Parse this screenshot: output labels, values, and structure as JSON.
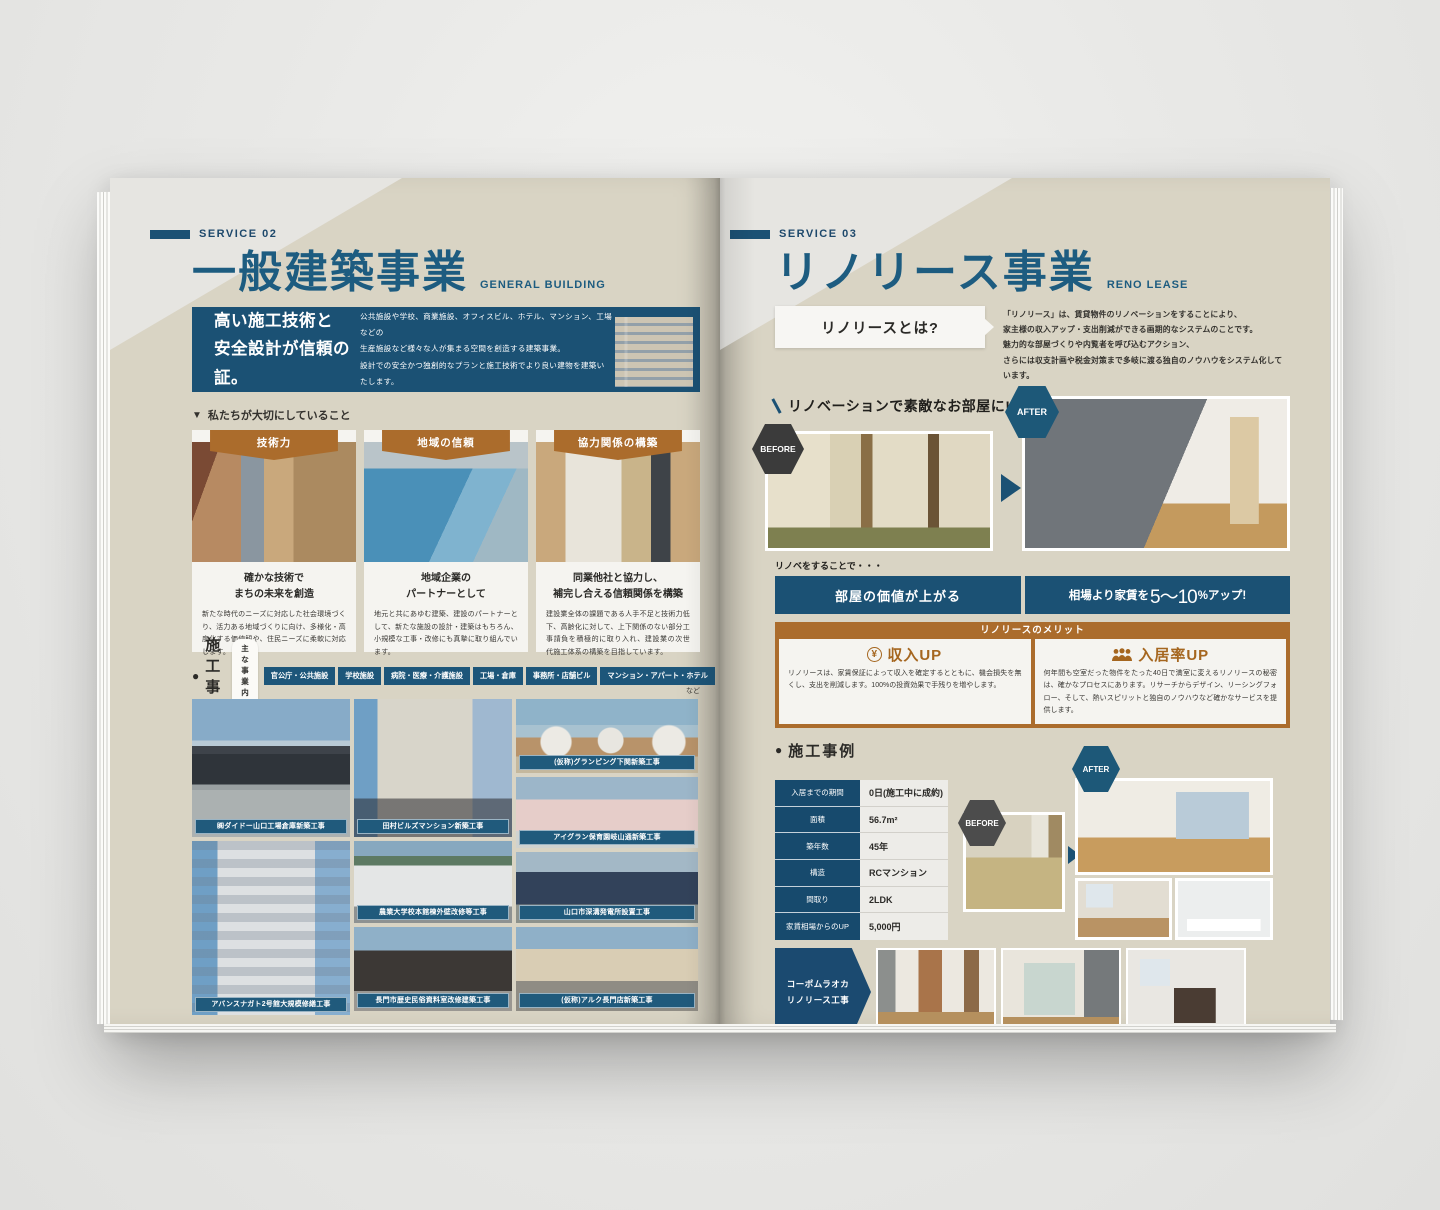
{
  "theme": {
    "primary_blue": "#1b5174",
    "accent_orange": "#ab6c2c",
    "page_beige": "#d9d4c4"
  },
  "icons": {
    "values_marker": "▼",
    "works_marker": "●",
    "yen": "¥"
  },
  "page_left": {
    "service_tag": "SERVICE 02",
    "title": "一般建築事業",
    "title_en": "GENERAL BUILDING",
    "page_number": "03",
    "hero": {
      "headline1": "高い施工技術と",
      "headline2": "安全設計が信頼の証。",
      "desc1": "公共施設や学校、商業施設、オフィスビル、ホテル、マンション、工場などの",
      "desc2": "生産施設など様々な人が集まる空間を創造する建築事業。",
      "desc3": "設計での安全かつ独創的なプランと施工技術でより良い建物を建築いたします。"
    },
    "values_heading": "私たちが大切にしていること",
    "cards": [
      {
        "badge": "技術力",
        "title1": "確かな技術で",
        "title2": "まちの未来を創造",
        "body": "新たな時代のニーズに対応した社会環境づくり、活力ある地域づくりに向け、多様化・高度化する価値観や、住民ニーズに柔軟に対応します。"
      },
      {
        "badge": "地域の信頼",
        "title1": "地域企業の",
        "title2": "パートナーとして",
        "body": "地元と共にあゆむ建築、建設のパートナーとして、新たな施設の設計・建築はもちろん、小規模な工事・改修にも真摯に取り組んでいます。"
      },
      {
        "badge": "協力関係の構築",
        "title1": "同業他社と協力し、",
        "title2": "補完し合える信頼関係を構築",
        "body": "建設業全体の課題である人手不足と技術力低下、高齢化に対して、上下関係のない部分工事請負を積極的に取り入れ、建設業の次世代施工体系の構築を目指しています。"
      }
    ],
    "works": {
      "heading": "施工事例",
      "pill": "主な事業内容",
      "tags": [
        "官公庁・公共施設",
        "学校施設",
        "病院・医療・介護施設",
        "工場・倉庫",
        "事務所・店舗ビル",
        "マンション・アパート・ホテル"
      ],
      "tags_note": "など",
      "col1": [
        "㈱ダイドー山口工場倉庫新築工事",
        "アバンスナガト2号館大規模修繕工事"
      ],
      "col2": [
        "田村ビルズマンション新築工事",
        "農業大学校本館棟外壁改修等工事",
        "長門市歴史民俗資料室改修建築工事"
      ],
      "col3": [
        "(仮称)グランピング下関新築工事",
        "アイグラン保育園岐山通新築工事",
        "山口市深溝発電所設置工事",
        "(仮称)アルク長門店新築工事"
      ]
    }
  },
  "page_right": {
    "service_tag": "SERVICE 03",
    "title": "リノリース事業",
    "title_en": "RENO LEASE",
    "page_number": "04",
    "intro": {
      "label": "リノリースとは?",
      "desc1": "「リノリース」は、賃貸物件のリノベーションをすることにより、",
      "desc2": "家主様の収入アップ・支出削減ができる画期的なシステムのことです。",
      "desc3": "魅力的な部屋づくりや内覧者を呼び込むアクション、",
      "desc4": "さらには収支計画や税金対策まで多岐に渡る独自のノウハウをシステム化しています。"
    },
    "renov_label": "リノベーションで素敵なお部屋に!",
    "before_label": "BEFORE",
    "after_label": "AFTER",
    "renobe_note": "リノベをすることで・・・",
    "bar1": "部屋の価値が上がる",
    "bar2_prefix": "相場より家賃を",
    "bar2_value": "5〜10",
    "bar2_suffix": "%アップ!",
    "merit": {
      "heading": "リノリースのメリット",
      "m1_title": "収入UP",
      "m1_body": "リノリースは、家賃保証によって収入を確定するとともに、機会損失を無くし、支出を削減します。100%の投資効果で手残りを増やします。",
      "m2_title": "入居率UP",
      "m2_body": "何年間も空室だった物件をたった40日で満室に変えるリノリースの秘密は、確かなプロセスにあります。リサーチからデザイン、リーシングフォロー、そして、熱いスピリットと独自のノウハウなど確かなサービスを提供します。"
    },
    "case": {
      "heading": "施工事例",
      "rows": [
        {
          "label": "入居までの期間",
          "value": "0日(施工中に成約)"
        },
        {
          "label": "面積",
          "value": "56.7m²"
        },
        {
          "label": "築年数",
          "value": "45年"
        },
        {
          "label": "構造",
          "value": "RCマンション"
        },
        {
          "label": "間取り",
          "value": "2LDK"
        },
        {
          "label": "家賃相場からのUP",
          "value": "5,000円"
        }
      ]
    },
    "bottom_label1": "コーポムラオカ",
    "bottom_label2": "リノリース工事"
  }
}
